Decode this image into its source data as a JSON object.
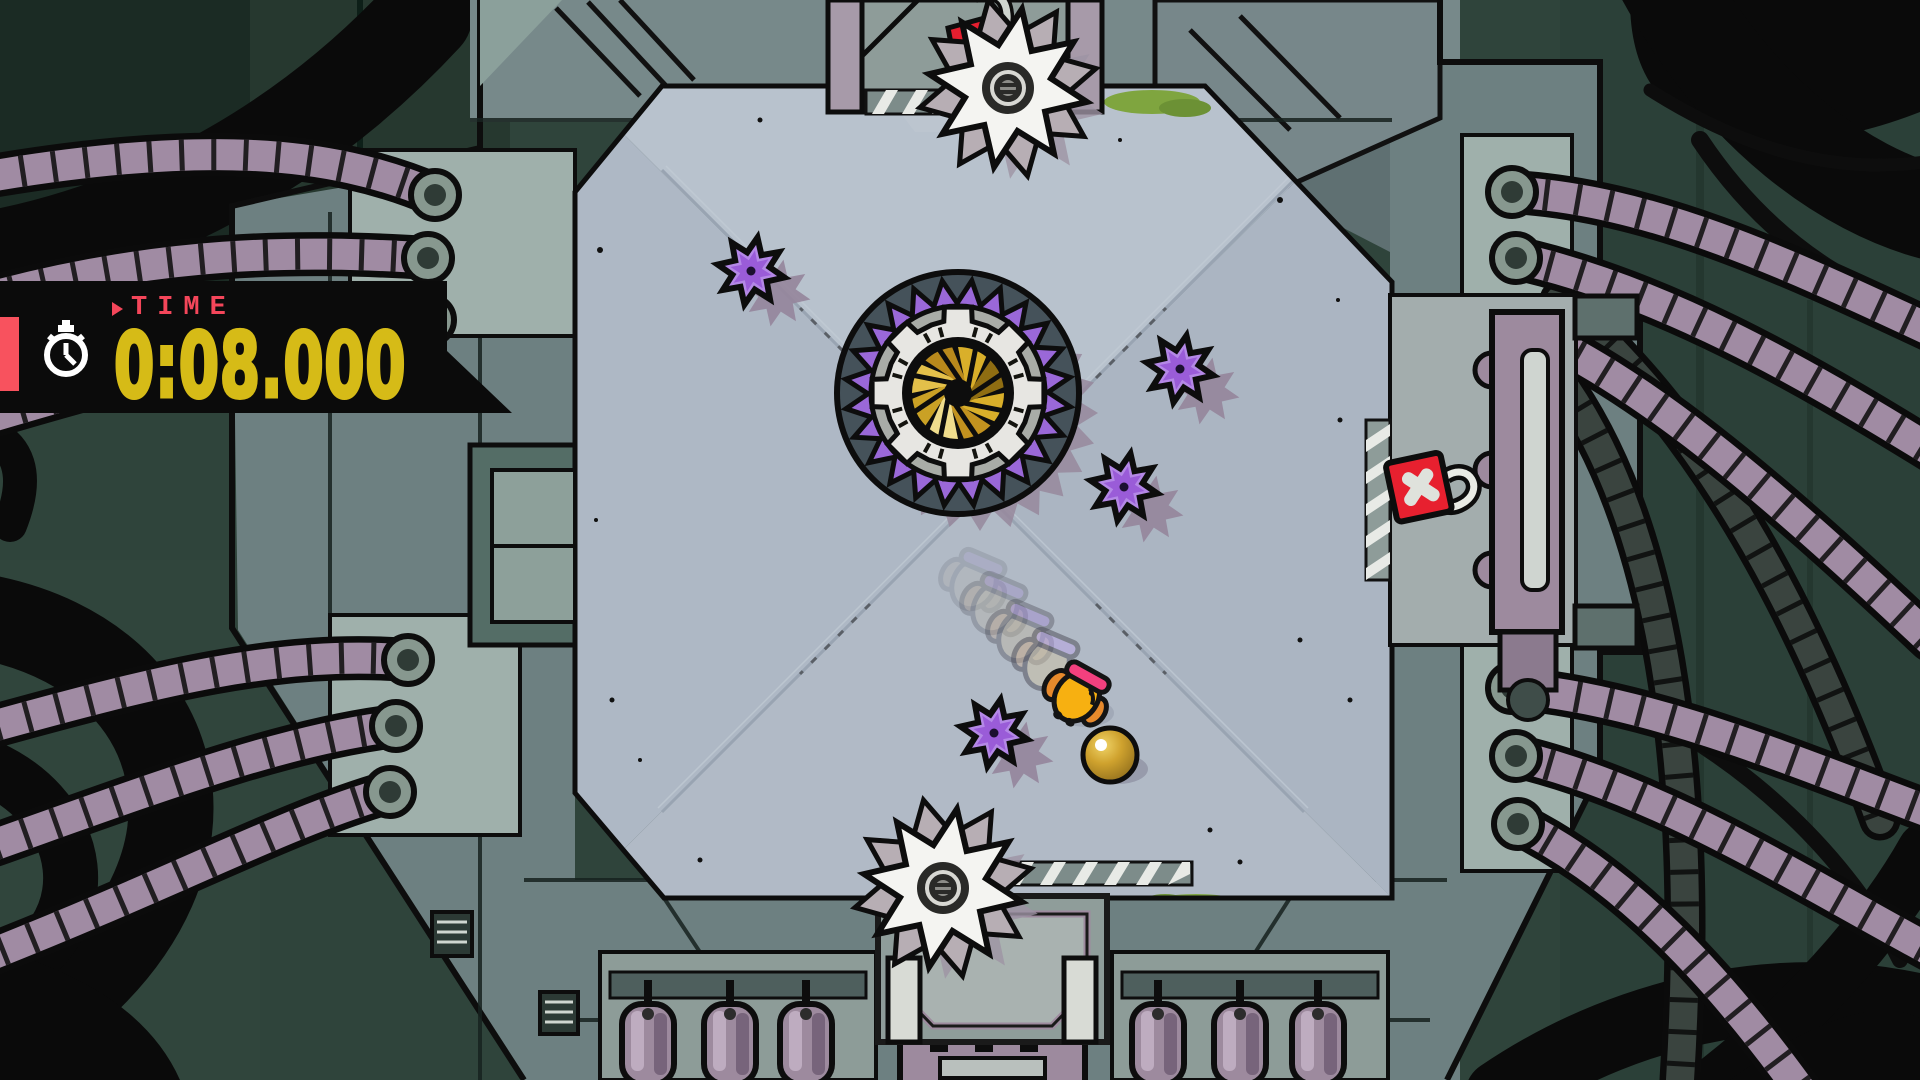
{
  "hud": {
    "time_label": "TIME",
    "time_value": "0:08.000",
    "icons": [
      "stopwatch-icon",
      "triangle-pointer-icon"
    ],
    "colors": {
      "panel": "#0b0b0b",
      "accent_stripe": "#f8525e",
      "label": "#f4465a",
      "value": "#d6bb17",
      "icon": "#ffffff"
    }
  },
  "game": {
    "viewport": {
      "width": 1920,
      "height": 1080
    },
    "entities": {
      "central_disc": {
        "x": 958,
        "y": 393,
        "outer_radius": 121
      },
      "spike_discs": [
        {
          "x": 751,
          "y": 271
        },
        {
          "x": 1180,
          "y": 369
        },
        {
          "x": 1124,
          "y": 487
        },
        {
          "x": 994,
          "y": 733
        }
      ],
      "saw_blades": [
        {
          "x": 1008,
          "y": 88
        },
        {
          "x": 943,
          "y": 888
        }
      ],
      "player": {
        "x": 1078,
        "y": 695,
        "heading_deg": 35,
        "trail": [
          {
            "dx": -30,
            "dy": -33,
            "o": 0.5
          },
          {
            "dx": -56,
            "dy": -61,
            "o": 0.36
          },
          {
            "dx": -82,
            "dy": -89,
            "o": 0.24
          },
          {
            "dx": -103,
            "dy": -113,
            "o": 0.14
          }
        ]
      },
      "gold_ball": {
        "x": 1110,
        "y": 755,
        "radius": 27
      },
      "exit_sign": {
        "x": 1420,
        "y": 488
      }
    },
    "palette": {
      "floor": "#afb9c6",
      "wall": "#6d8081",
      "background": "#2f443b",
      "spike_disc": "#b488e6",
      "spike_disc_core": "#9a5cd8",
      "disc_ring_purple": "#9a68d8",
      "disc_gear": "#e7e6e2",
      "iris_gold": "#d9af2a",
      "saw": "#f4f4f1",
      "tube": "#a08ba3",
      "player_body": "#f7b011",
      "player_band": "#f3407e",
      "player_arm": "#e78a2c",
      "ball": "#cfa22e",
      "exit_red": "#e7202f"
    }
  }
}
